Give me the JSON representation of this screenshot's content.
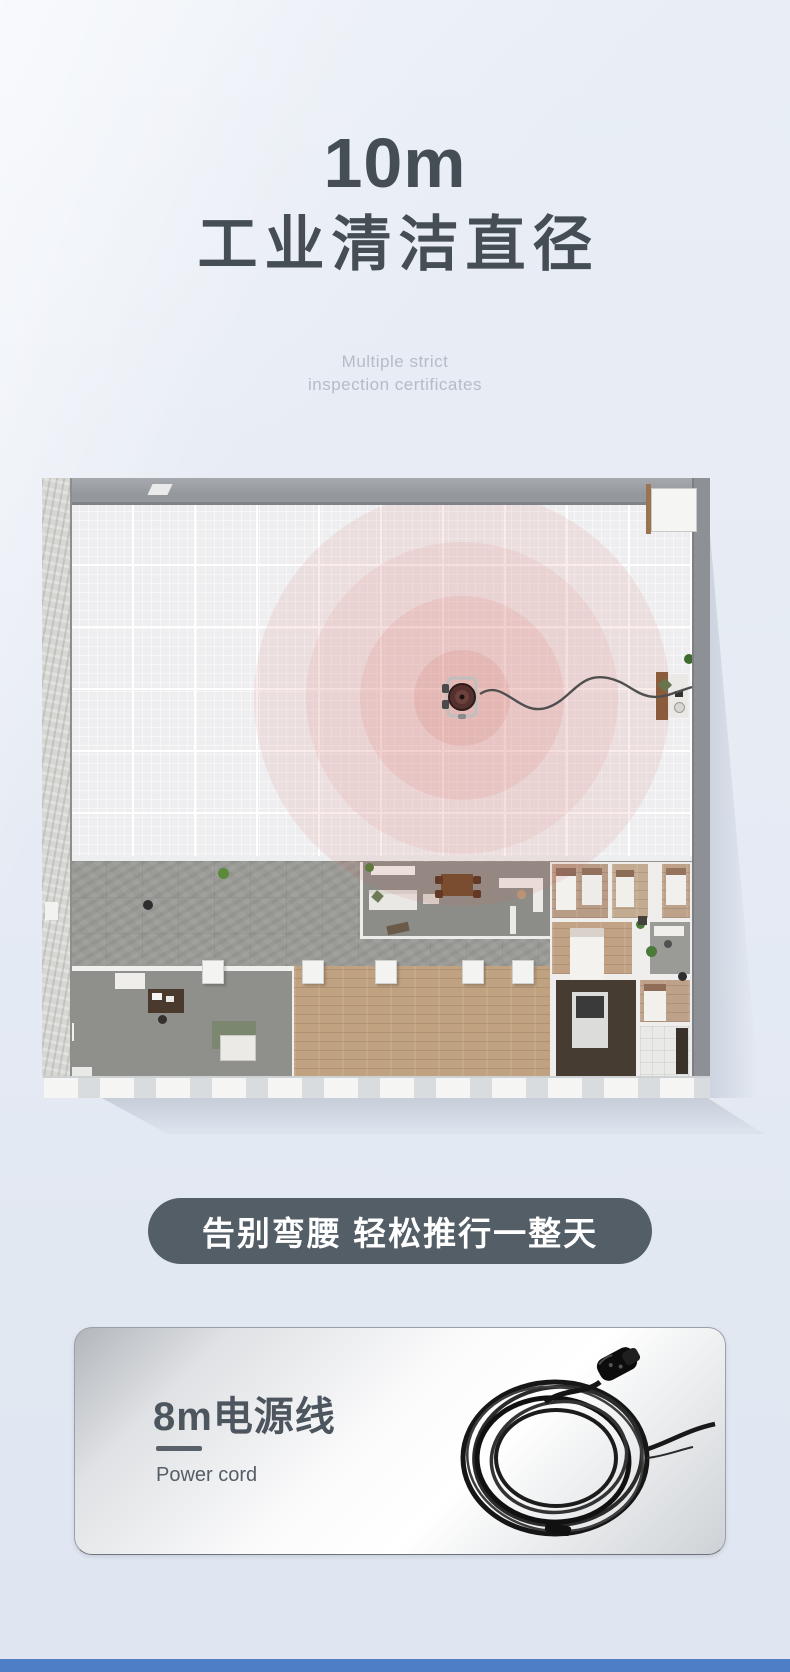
{
  "page": {
    "background_color": "#e6ebf4",
    "accent_dark": "#545e66",
    "footer_strip_color": "#4d7ec6"
  },
  "hero": {
    "headline_value": "10m",
    "headline_label": "工业清洁直径",
    "subtitle_line1": "Multiple strict",
    "subtitle_line2": "inspection certificates",
    "text_color": "#454d55",
    "subtitle_color": "#b5bcc6"
  },
  "floor_plan": {
    "coverage_ring_count": 4,
    "coverage_color": "#d96a5e",
    "hall_floor_color": "#eeeef1",
    "corridor_floor_color": "#9b9b97",
    "wood_floor_color": "#c0a281"
  },
  "banner": {
    "text": "告别弯腰 轻松推行一整天",
    "background": "#545e66",
    "text_color": "#ffffff"
  },
  "feature_card": {
    "title": "8m电源线",
    "subtitle": "Power cord",
    "title_color": "#4d565f"
  }
}
